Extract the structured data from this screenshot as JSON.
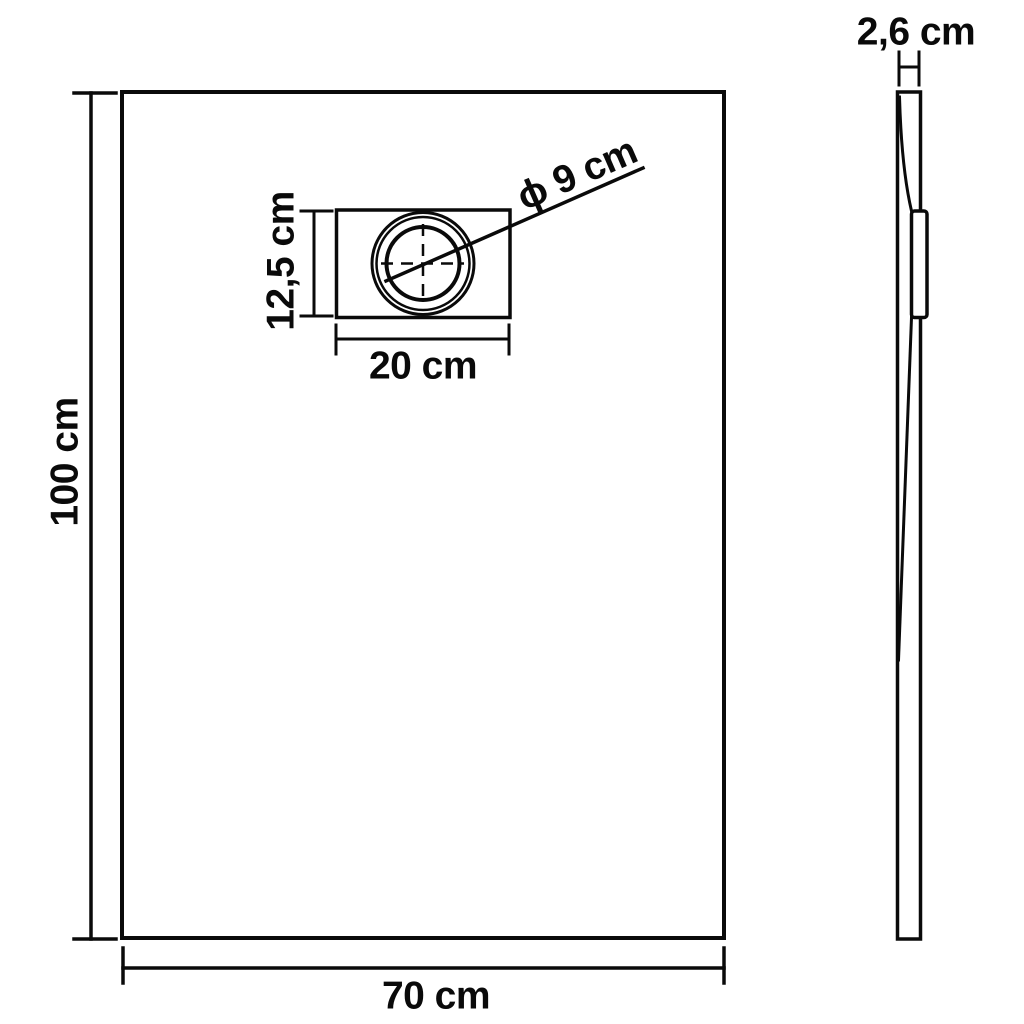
{
  "diagram_title": "shower-tray-dimension-drawing",
  "colors": {
    "line": "#0a0a0a",
    "background": "#ffffff",
    "text": "#0a0a0a"
  },
  "front_view": {
    "height_label": "100 cm",
    "width_label": "70 cm",
    "drain": {
      "height_label": "12,5 cm",
      "width_label": "20 cm",
      "diameter_label": "ϕ 9 cm"
    }
  },
  "side_view": {
    "thickness_label": "2,6 cm"
  }
}
